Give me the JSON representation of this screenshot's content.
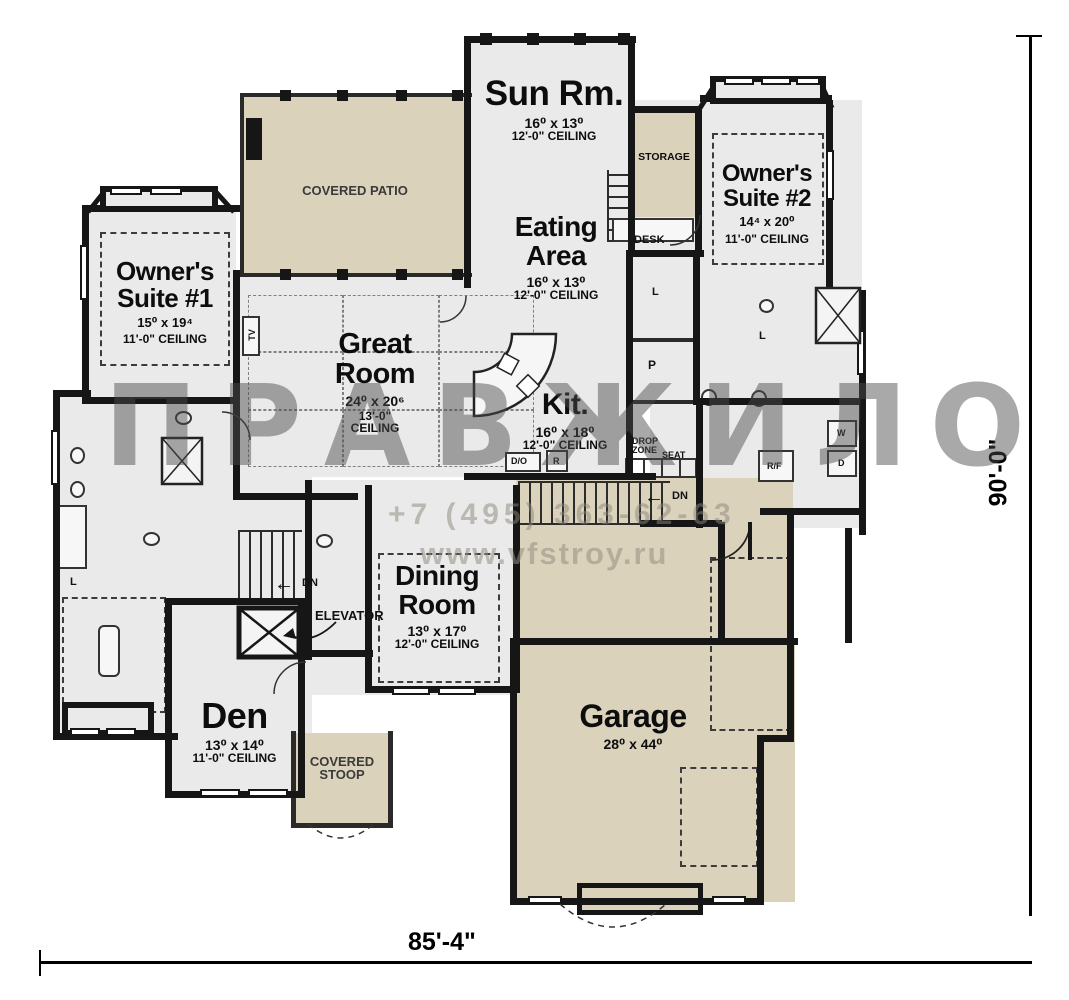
{
  "watermark": {
    "big_text": "ПРАВЖИЛО",
    "phone": "+7 (495) 363-62-63",
    "website": "www.vfstroy.ru"
  },
  "plan_dimensions": {
    "width_label": "85'-4\"",
    "depth_label": "90'-0\""
  },
  "rooms": {
    "sun_room": {
      "name": "Sun Rm.",
      "size": "16⁰ x 13⁰",
      "ceiling": "12'-0\" CEILING"
    },
    "eating_area": {
      "name": "Eating Area",
      "size": "16⁰ x 13⁰",
      "ceiling": "12'-0\" CEILING"
    },
    "owners_suite_2": {
      "name": "Owner's Suite #2",
      "size": "14⁴ x 20⁰",
      "ceiling": "11'-0\" CEILING"
    },
    "owners_suite_1": {
      "name": "Owner's Suite #1",
      "size": "15⁰ x 19⁴",
      "ceiling": "11'-0\" CEILING"
    },
    "great_room": {
      "name": "Great Room",
      "size": "24⁰ x 20⁶",
      "ceiling": "13'-0\" CEILING"
    },
    "kitchen": {
      "name": "Kit.",
      "size": "16⁰ x 18⁰",
      "ceiling": "12'-0\" CEILING"
    },
    "dining_room": {
      "name": "Dining Room",
      "size": "13⁰ x 17⁰",
      "ceiling": "12'-0\" CEILING"
    },
    "den": {
      "name": "Den",
      "size": "13⁰ x 14⁰",
      "ceiling": "11'-0\" CEILING"
    },
    "garage": {
      "name": "Garage",
      "size": "28⁰ x 44⁰"
    }
  },
  "areas": {
    "covered_patio": "COVERED PATIO",
    "covered_stoop": "COVERED STOOP",
    "storage": "STORAGE",
    "elevator": "ELEVATOR"
  },
  "labels": {
    "desk": "DESK",
    "drop_zone": "DROP ZONE",
    "seat": "SEAT",
    "double_oven": "D/O",
    "range": "R",
    "pantry": "P",
    "linen": "L",
    "washer": "W",
    "dryer": "D",
    "refrigerator": "R/F",
    "tv": "TV",
    "down": "DN"
  }
}
